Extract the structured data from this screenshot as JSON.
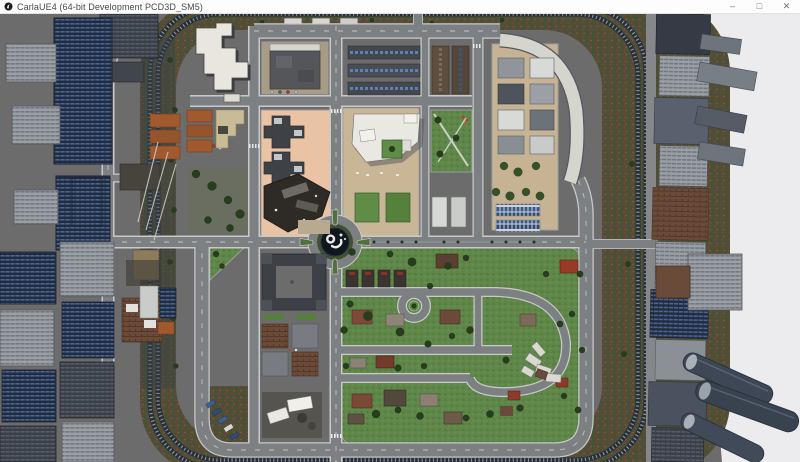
{
  "window": {
    "title": "CarlaUE4 (64-bit Development PCD3D_SM5)",
    "icon": "unreal-engine-icon",
    "controls": {
      "minimize": "–",
      "maximize": "□",
      "close": "✕"
    }
  },
  "map": {
    "colors": {
      "ground": "#6c6c6c",
      "road": "#7d8083",
      "road_edge": "#c9c9c9",
      "grass": "#5f8749",
      "foliage_band": "#4d4f39",
      "rail": "#2a313c",
      "peach_block": "#eac3a4",
      "tan_block": "#c9b696",
      "plaza": "#c5b394",
      "white_building": "#e8e6df",
      "roundabout_center": "#10161e",
      "roundabout_green": "#3f5233",
      "parked_cars_blue": "#3a5a8a",
      "void": "#ececee"
    },
    "landmarks": [
      "ring-railway",
      "central-roundabout-sculpture",
      "residential-district",
      "apartment-blocks",
      "central-plaza",
      "level-crossings"
    ]
  }
}
